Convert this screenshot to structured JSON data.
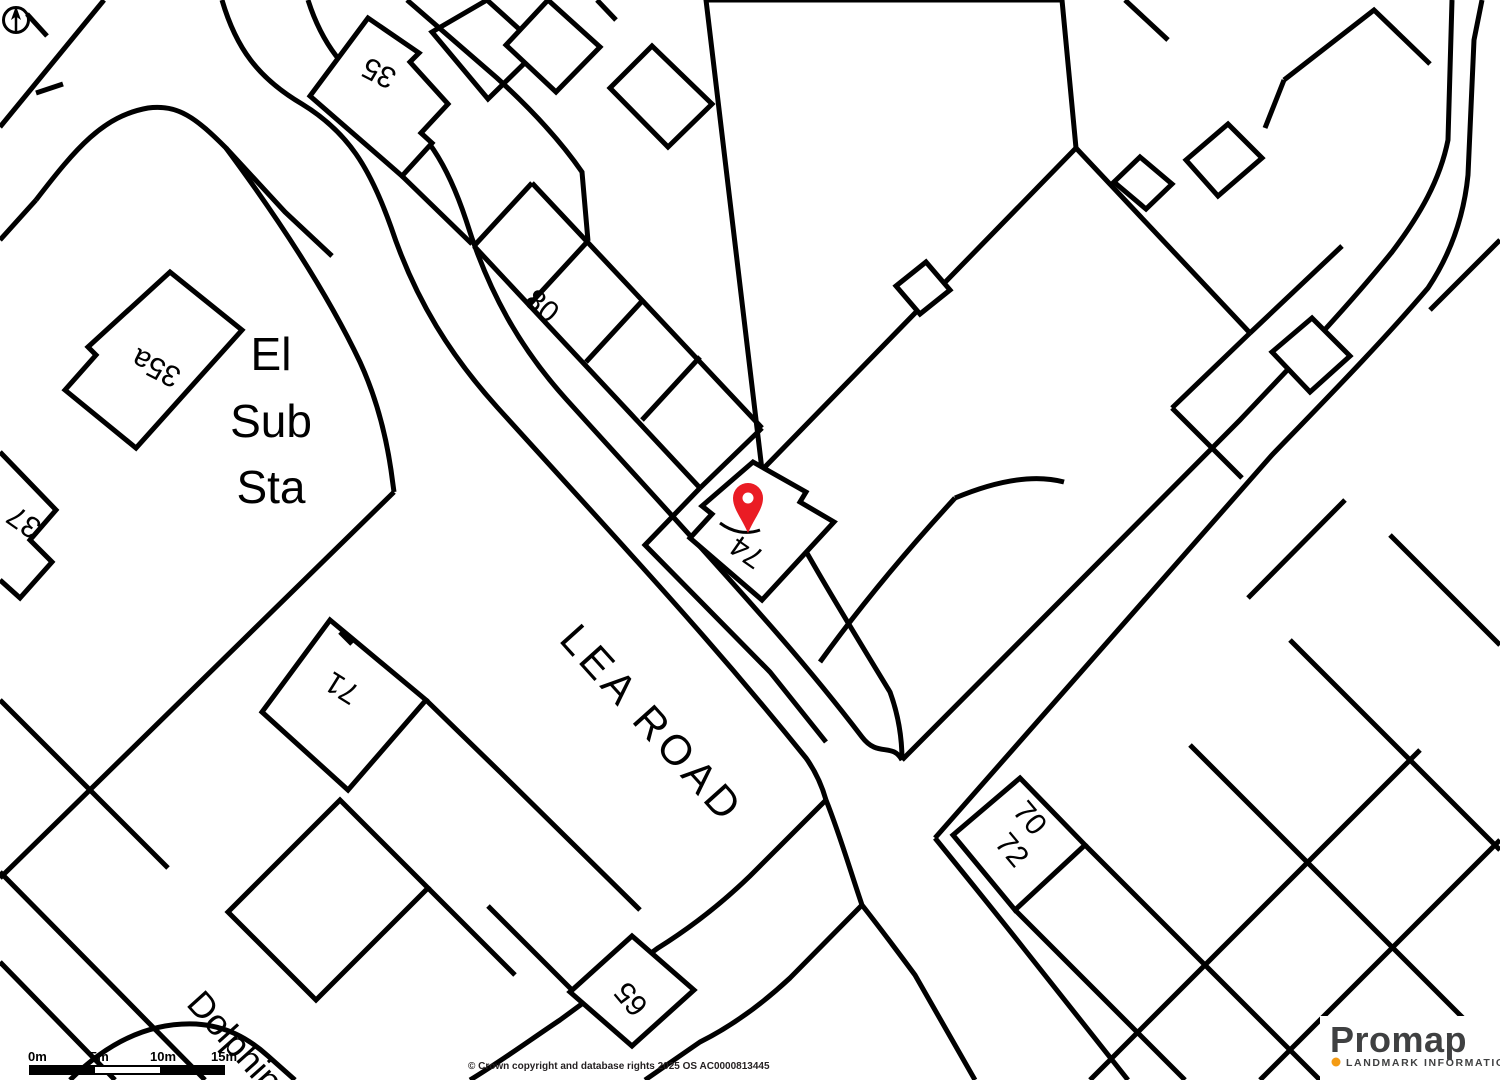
{
  "map": {
    "road_name": "LEA ROAD",
    "street_name_partial": "Dolphin",
    "substation": {
      "line1": "El",
      "line2": "Sub",
      "line3": "Sta"
    },
    "house_numbers": {
      "n35": "35",
      "n35a": "35a",
      "n37": "37",
      "n65": "65",
      "n70": "70",
      "n71": "71",
      "n72": "72",
      "n74": "74",
      "n80": "80"
    },
    "marker_color": "#ea1c24",
    "line_color": "#000000",
    "background_color": "#ffffff"
  },
  "scale_bar": {
    "ticks": [
      "0m",
      "5m",
      "10m",
      "15m"
    ]
  },
  "attribution": {
    "copyright": "© Crown copyright and database rights 2025 OS AC0000813445"
  },
  "branding": {
    "logo_text": "Promap",
    "tagline": "LANDMARK INFORMATION",
    "accent_color": "#f49b13",
    "logo_color": "#3f4041"
  }
}
